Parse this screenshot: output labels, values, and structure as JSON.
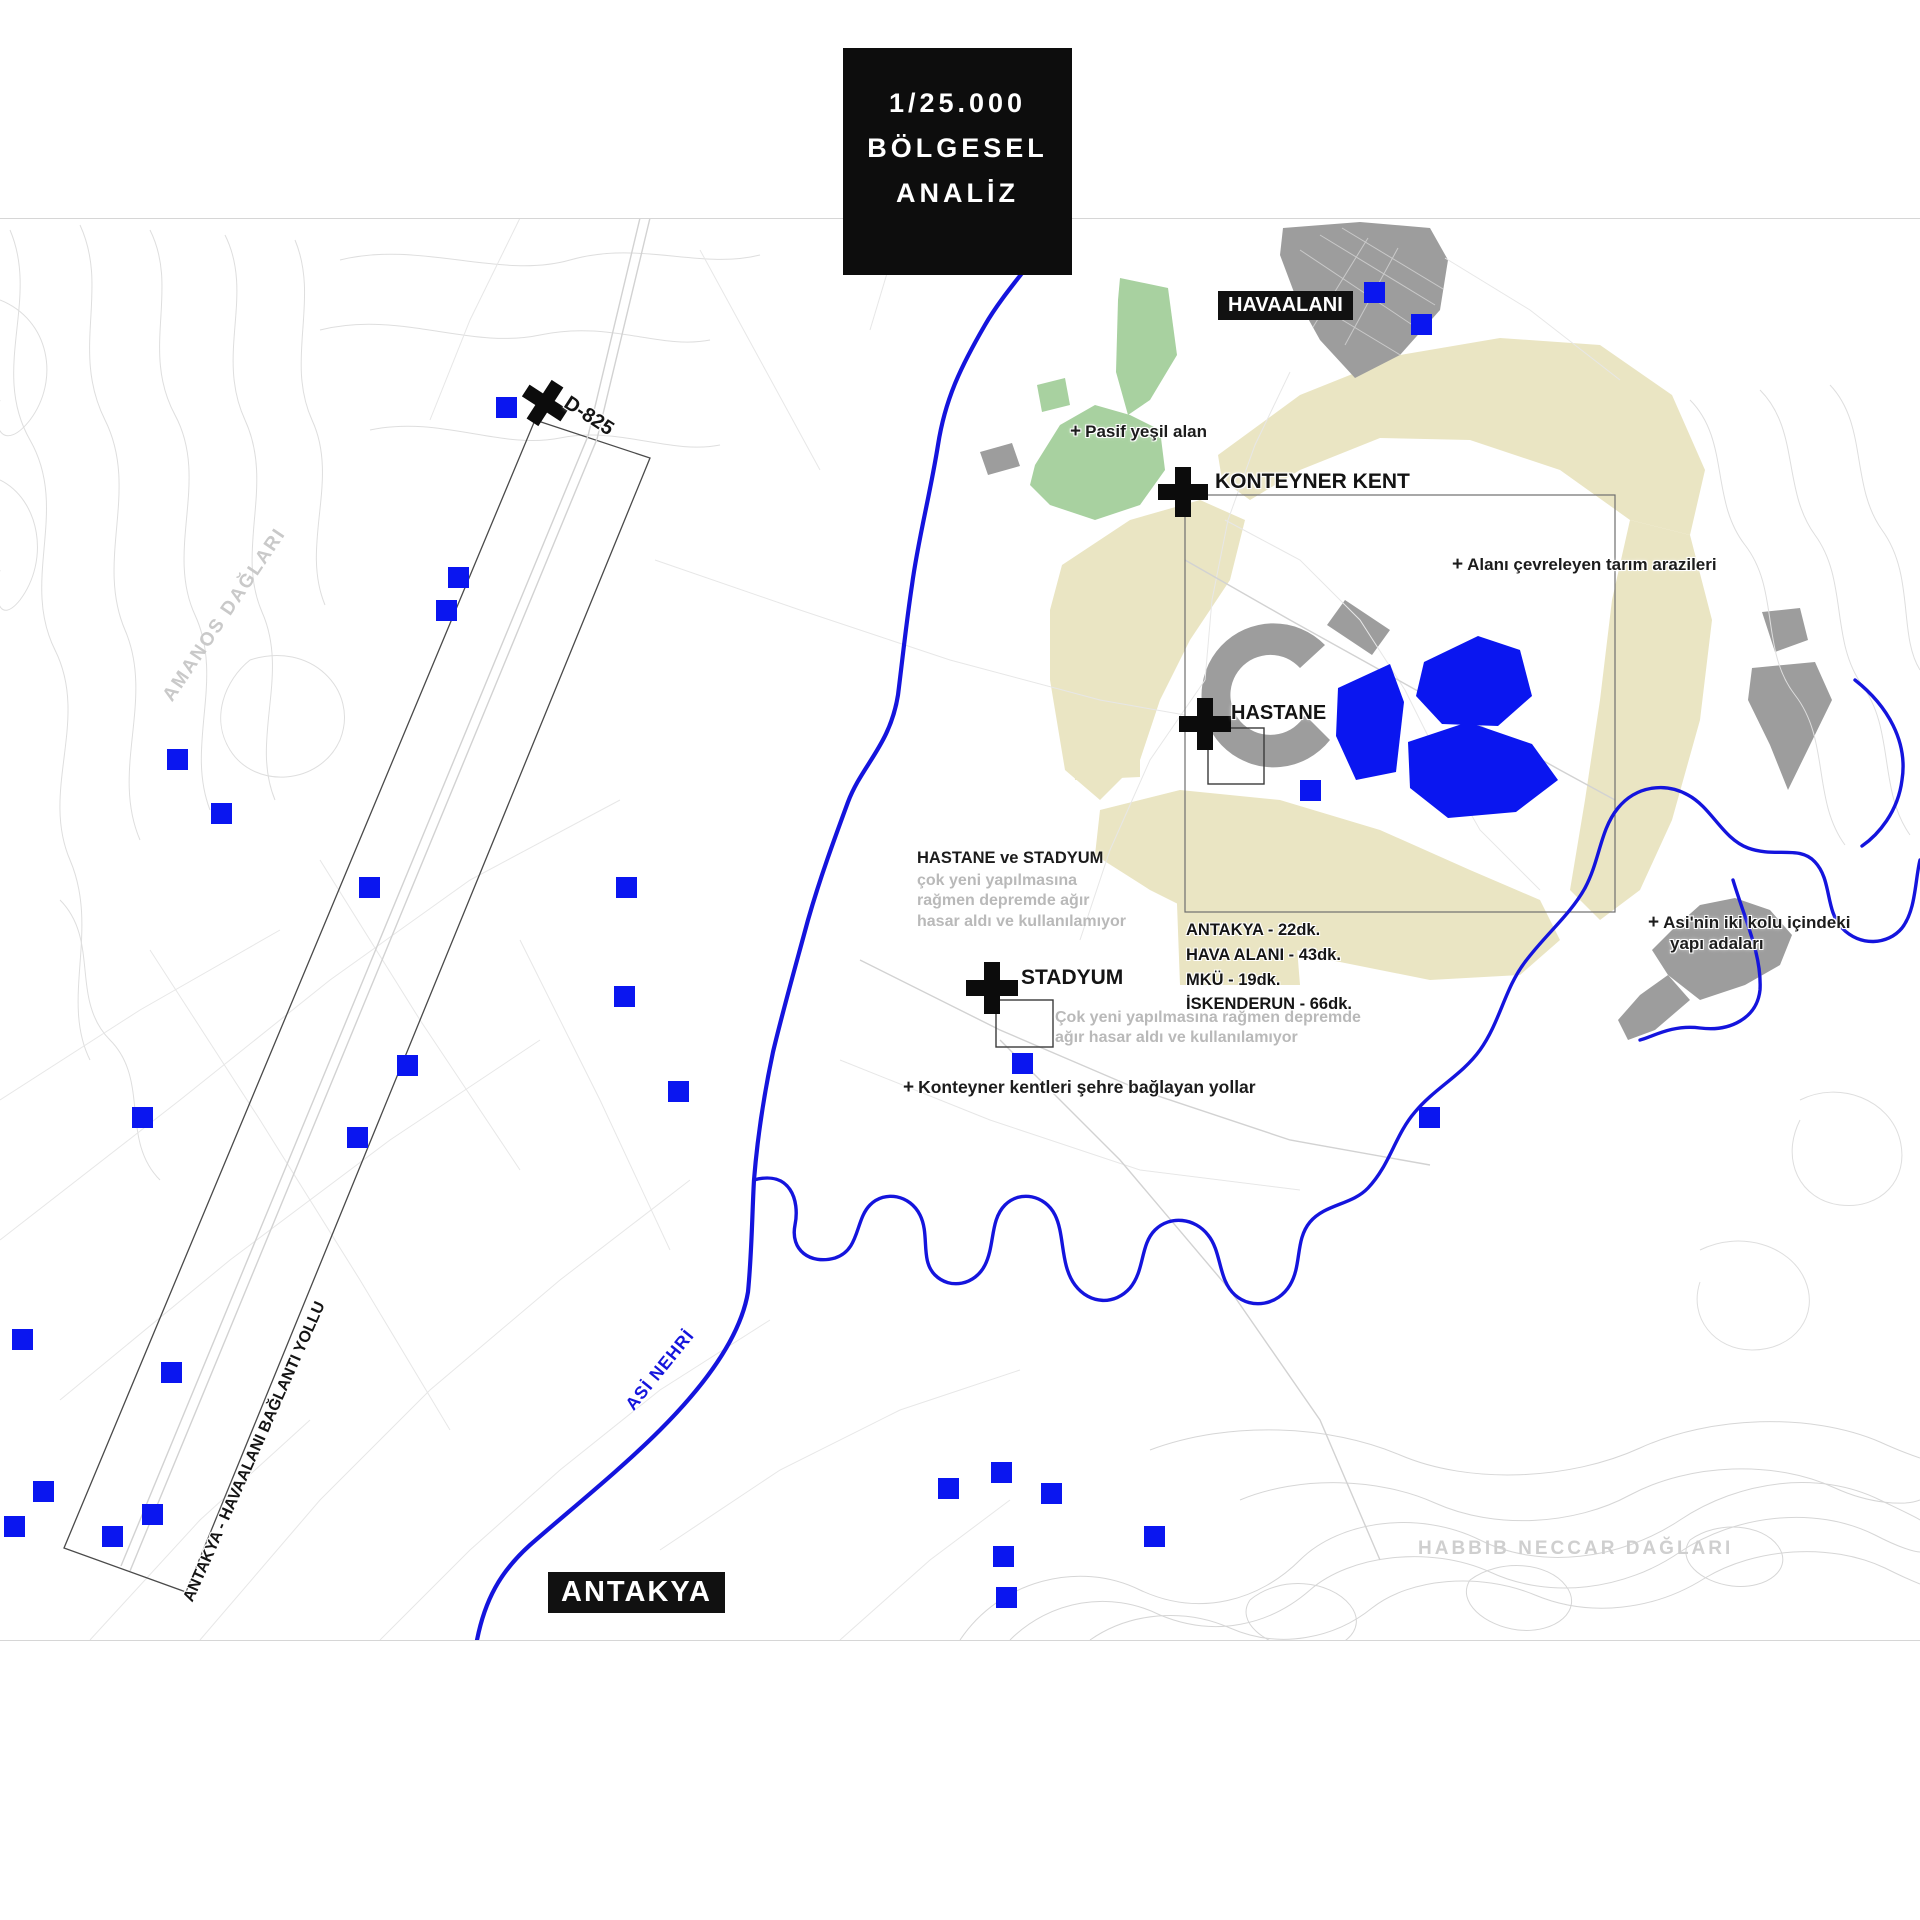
{
  "title": {
    "lines": [
      "1/25.000",
      "BÖLGESEL",
      "ANALİZ"
    ]
  },
  "labels": {
    "havaalani": "HAVAALANI",
    "konteyner_kent": "KONTEYNER KENT",
    "hastane": "HASTANE",
    "stadyum": "STADYUM",
    "antakya": "ANTAKYA",
    "d825": "D-825",
    "asi_nehri": "ASİ NEHRİ",
    "baglanti_yolu": "ANTAKYA - HAVAALANI BAĞLANTI YOLLU",
    "amanos_daglari": "AMANOS DAĞLARI",
    "habbib_neccar_daglari": "HABBIB NECCAR DAĞLARI"
  },
  "annotations": {
    "plus": "+",
    "pasif_yesil": "Pasif yeşil alan",
    "tarim_arazileri": "Alanı çevreleyen tarım arazileri",
    "asi_line1": "Asi'nin iki kolu içindeki",
    "asi_line2": "yapı adaları",
    "konteyner_yollar": "Konteyner kentleri şehre bağlayan yollar",
    "hastane_stadyum_title": "HASTANE ve STADYUM",
    "hastane_stadyum_note": "çok yeni yapılmasına rağmen depremde ağır hasar aldı ve kullanılamıyor",
    "stadyum_note": "Çok yeni yapılmasına rağmen depremde ağır hasar aldı ve kullanılamıyor"
  },
  "distances": [
    "ANTAKYA - 22dk.",
    "HAVA ALANI - 43dk.",
    "MKÜ - 19dk.",
    "İSKENDERUN - 66dk."
  ],
  "colors": {
    "water": "#1414dd",
    "marker": "#0a16f0",
    "green": "#a8d1a0",
    "farmland": "#eae5c3",
    "urban": "#9d9d9d",
    "labelbg": "#111111"
  },
  "markers": {
    "blue_squares": [
      [
        496,
        397
      ],
      [
        1364,
        282
      ],
      [
        1411,
        314
      ],
      [
        448,
        567
      ],
      [
        436,
        600
      ],
      [
        167,
        749
      ],
      [
        211,
        803
      ],
      [
        359,
        877
      ],
      [
        616,
        877
      ],
      [
        614,
        986
      ],
      [
        397,
        1055
      ],
      [
        668,
        1081
      ],
      [
        132,
        1107
      ],
      [
        347,
        1127
      ],
      [
        1419,
        1107
      ],
      [
        12,
        1329
      ],
      [
        161,
        1362
      ],
      [
        33,
        1481
      ],
      [
        142,
        1504
      ],
      [
        102,
        1526
      ],
      [
        4,
        1516
      ],
      [
        938,
        1478
      ],
      [
        991,
        1462
      ],
      [
        1041,
        1483
      ],
      [
        993,
        1546
      ],
      [
        996,
        1587
      ],
      [
        1144,
        1526
      ],
      [
        1300,
        780
      ],
      [
        1012,
        1053
      ]
    ]
  }
}
